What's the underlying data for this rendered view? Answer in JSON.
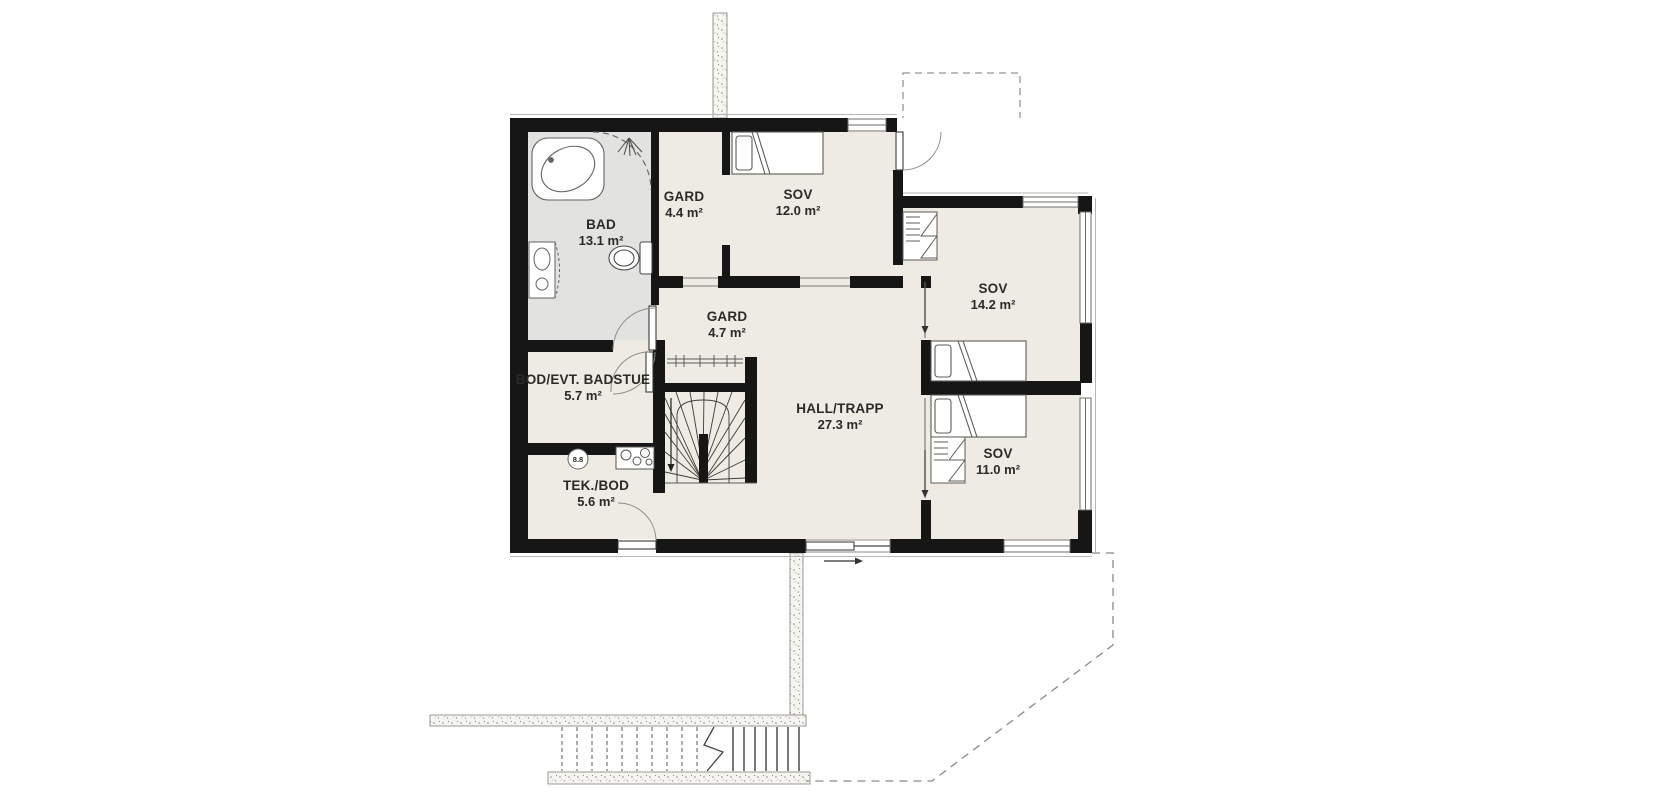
{
  "plan": {
    "rooms": [
      {
        "name": "BAD",
        "area": "13.1 m²"
      },
      {
        "name": "GARD",
        "area": "4.4 m²"
      },
      {
        "name": "SOV",
        "area": "12.0 m²"
      },
      {
        "name": "SOV",
        "area": "14.2 m²"
      },
      {
        "name": "GARD",
        "area": "4.7 m²"
      },
      {
        "name": "HALL/TRAPP",
        "area": "27.3 m²"
      },
      {
        "name": "BOD/EVT. BADSTUE",
        "area": "5.7 m²"
      },
      {
        "name": "TEK./BOD",
        "area": "5.6 m²"
      },
      {
        "name": "SOV",
        "area": "11.0 m²"
      }
    ],
    "annotations": {
      "spot_label": "8.8"
    },
    "colors": {
      "wall": "#161616",
      "floor": "#edebe4",
      "bathroom_floor": "#e2e2e1",
      "furniture_line": "#555555",
      "dashed_line": "#8a8a8a"
    }
  }
}
